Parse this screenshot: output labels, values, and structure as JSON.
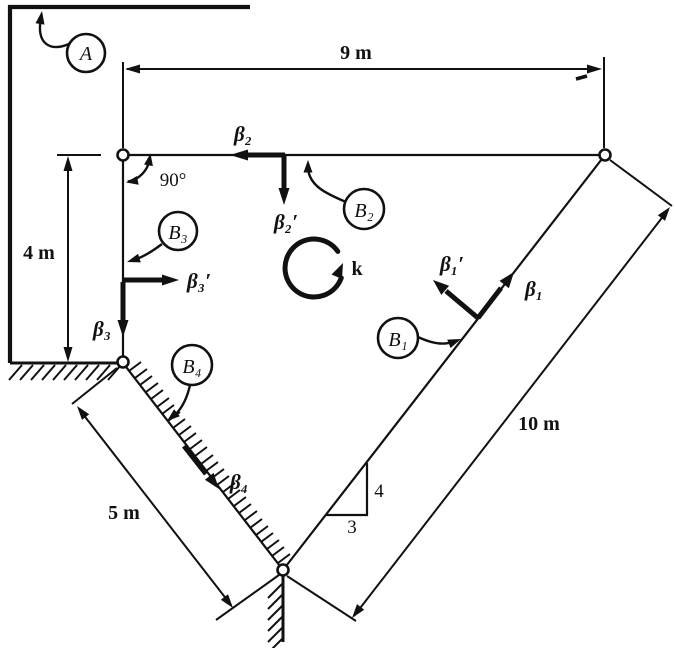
{
  "figure": {
    "dimensions": {
      "top_span": "9 m",
      "left_height": "4 m",
      "incline_length": "5 m",
      "diagonal_length": "10 m"
    },
    "slope_triangle": {
      "rise": "4",
      "run": "3"
    },
    "angle": {
      "right_angle": "90°"
    },
    "rotation_axis": {
      "label": "k"
    },
    "nodes": {
      "A": "A",
      "B1": "B₁",
      "B2": "B₂",
      "B3": "B₃",
      "B4": "B₄"
    },
    "vectors": {
      "beta1": "β₁",
      "beta1_prime": "β₁′",
      "beta2": "β₂",
      "beta2_prime": "β₂′",
      "beta3": "β₃",
      "beta3_prime": "β₃′",
      "beta4": "β₄"
    },
    "colors": {
      "ink": "#111111",
      "paper": "#ffffff"
    }
  }
}
